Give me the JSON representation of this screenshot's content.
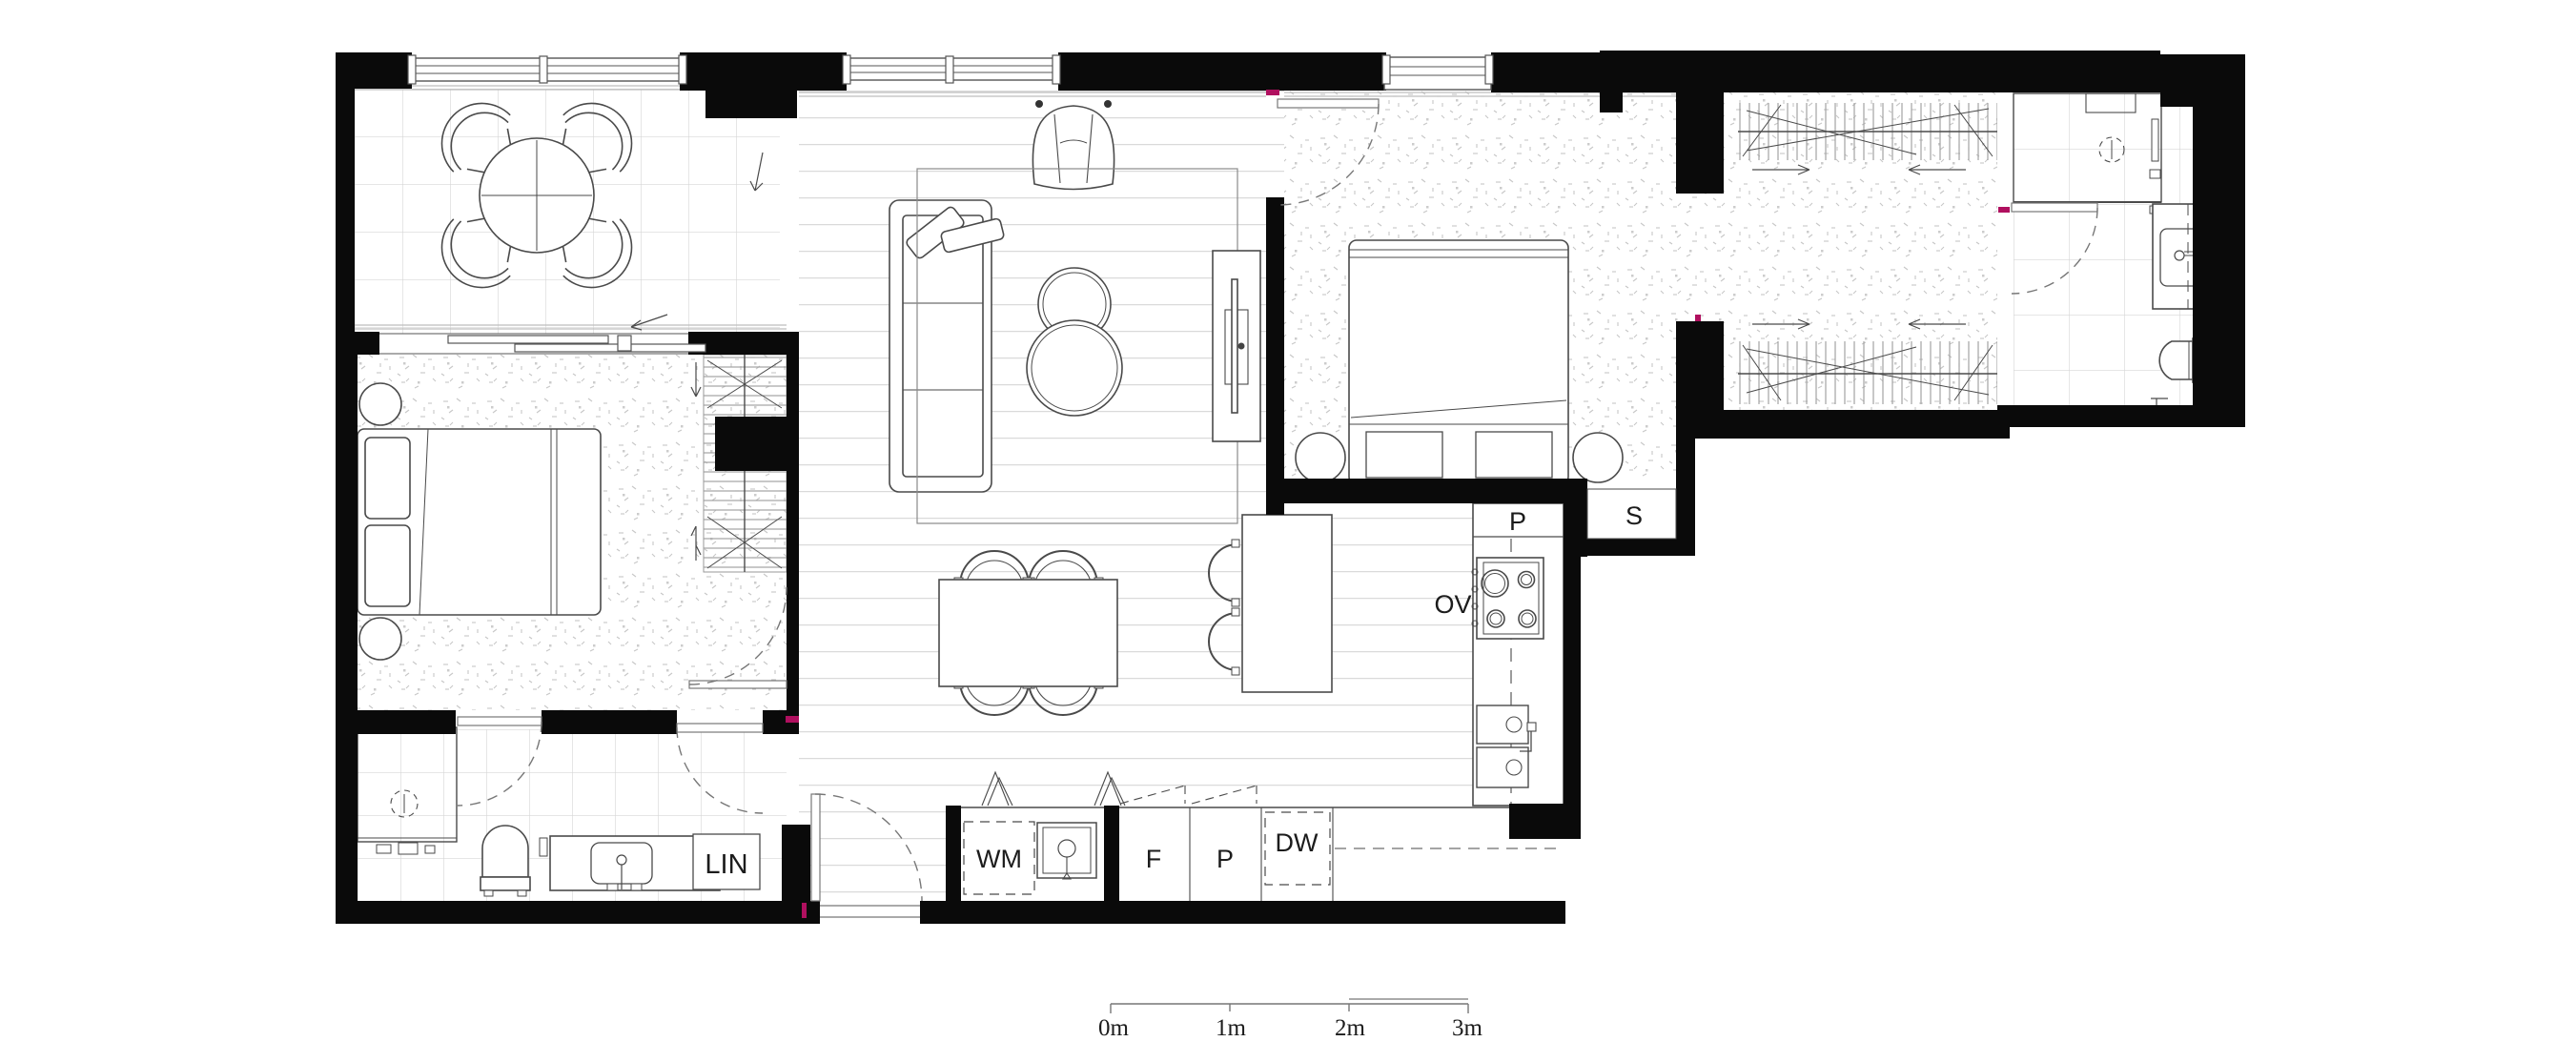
{
  "plan": {
    "title": "apartment-floor-plan",
    "labels": {
      "oven": "OV",
      "pantry_tall": "P",
      "storage": "S",
      "washing_machine": "WM",
      "fridge": "F",
      "pantry_bench": "P",
      "dishwasher": "DW",
      "linen": "LIN"
    },
    "scale_bar": {
      "tick0": "0m",
      "tick1": "1m",
      "tick2": "2m",
      "tick3": "3m"
    },
    "colors": {
      "wall": "#0a0a0a",
      "furniture_line": "#4a4a4a",
      "floor_line": "#d9d9d9",
      "accent": "#b0105f"
    }
  }
}
